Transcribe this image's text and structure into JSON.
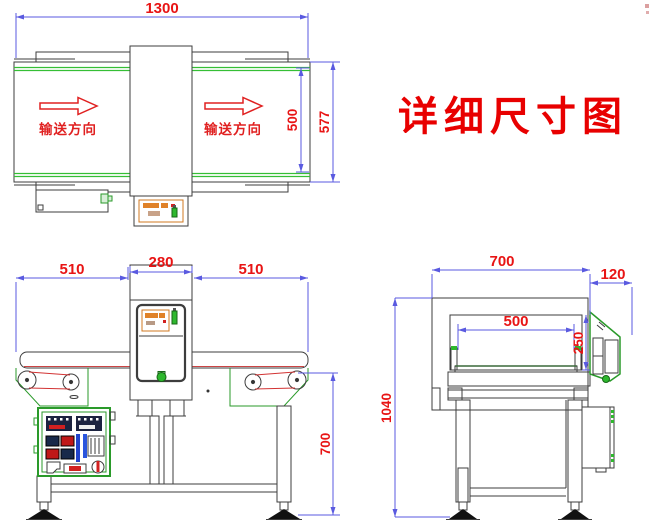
{
  "title": {
    "text": "详细尺寸图"
  },
  "top_view": {
    "dim_length": "1300",
    "dim_belt_width": "500",
    "dim_overall_width": "577",
    "flow_label_left": "输送方向",
    "flow_label_right": "输送方向"
  },
  "front_view": {
    "dim_left_section": "510",
    "dim_detector_width": "280",
    "dim_right_section": "510",
    "dim_belt_height": "700"
  },
  "side_view": {
    "dim_body_width": "700",
    "dim_panel_depth": "120",
    "dim_tunnel_width": "500",
    "dim_tunnel_height": "250",
    "dim_overall_height": "1040"
  },
  "colors": {
    "dimension_line": "#5a5ae0",
    "dimension_text": "#e81414",
    "drawing_outline": "#3d3d3d",
    "belt_green": "#35bf35",
    "display_orange": "#e08228",
    "title_red": "#e80000"
  }
}
